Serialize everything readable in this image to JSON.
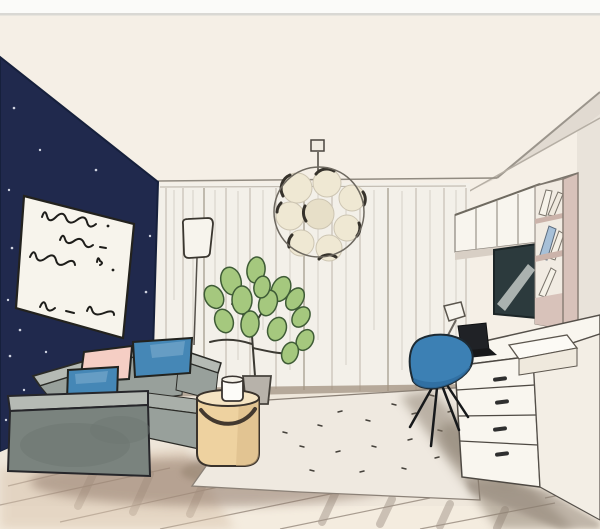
{
  "image": {
    "kind": "hand-drawn interior sketch",
    "alt": "Watercolor and ink sketch of a modern living room: navy accent wall with a framed print of handwritten lines, grey sofa with two blue cushions and one pink cushion, tan cylindrical pouf side table with a white mug, potted green plant, sheer curtains, a round bubble pendant lamp, and a white desk area with wall cabinets, bookshelf, dark TV screen, task lamp, black laptop and a blue shell chair on a pale rug over a wooden floor."
  },
  "scene": {
    "objects": [
      "navy accent wall with star dots",
      "framed art print with handwritten scribbles",
      "sheer curtain wall",
      "bubble pendant lamp",
      "floor lamp",
      "potted plant",
      "grey sofa",
      "blue cushions",
      "pink cushion",
      "tan pouf side table",
      "white mug",
      "pale speckled rug",
      "wooden plank floor",
      "wall cabinets",
      "bookshelf with books",
      "tv screen",
      "white desk with drawers",
      "storage box",
      "black laptop",
      "desk task lamp",
      "blue shell chair"
    ]
  },
  "colors": {
    "paper": "#f5efe6",
    "top_strip": "#fbfbf9",
    "divider": "#d9d8d4",
    "navy_wall": "#20294d",
    "star": "#e3e6f0",
    "art_paper": "#f7f4ec",
    "ink": "#201f1b",
    "curtain": "#f3f0e9",
    "sofa_light": "#b5bab4",
    "sofa_mid": "#98a09b",
    "sofa_dark": "#7a837e",
    "pillow_blue": "#4587b6",
    "pillow_pink": "#f5cec4",
    "pouf": "#eed2a0",
    "pouf_top": "#f5e4c3",
    "plant_green": "#a5c87e",
    "pot_gray": "#b7b2aa",
    "rug": "#efe9e0",
    "floor": "#efe7db",
    "wood_line": "#8f8276",
    "floor_shadow": "#8a7263",
    "chair_blue": "#3c80b4",
    "tv_dark": "#2c3a3d",
    "shelf_pink": "#d8c2ba",
    "book_blue": "#a7c0d8",
    "cabinet_white": "#f8f5ee",
    "desk_white": "#f9f6ef",
    "desk_side": "#f3eee5",
    "right_wall": "#e9e3da",
    "lamp_white": "#f7f4ed",
    "globe_cream": "#efe8d3"
  }
}
